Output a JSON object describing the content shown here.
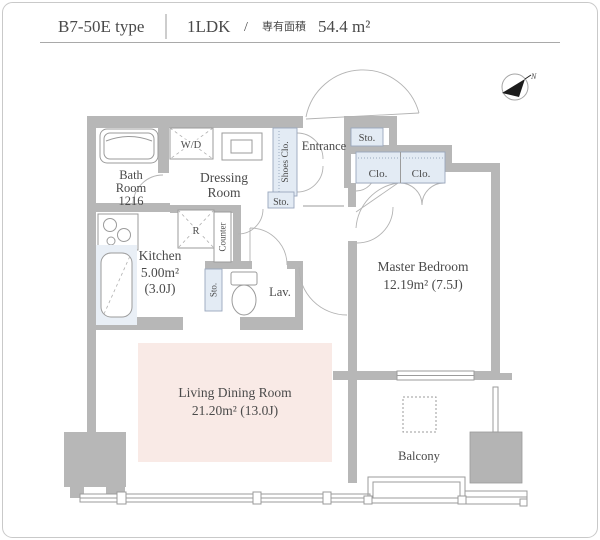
{
  "header": {
    "type_label": "B7-50E type",
    "layout_label": "1LDK",
    "separator": "/",
    "area_caption": "専有面積",
    "area_value": "54.4 m²"
  },
  "compass": {
    "label": "N"
  },
  "plan": {
    "bath": {
      "line1": "Bath",
      "line2": "Room",
      "line3": "1216"
    },
    "wd": {
      "label": "W/D"
    },
    "dressing": {
      "line1": "Dressing",
      "line2": "Room"
    },
    "shoes_closet": {
      "label": "Shoes Clo."
    },
    "hall_storage": {
      "label": "Sto."
    },
    "entrance": {
      "label": "Entrance"
    },
    "top_storage": {
      "label": "Sto."
    },
    "closets": {
      "left": "Clo.",
      "right": "Clo."
    },
    "kitchen": {
      "name": "Kitchen",
      "area": "5.00m²",
      "tatami": "(3.0J)"
    },
    "refrigerator": {
      "label": "R"
    },
    "counter": {
      "label": "Counter"
    },
    "lav_storage": {
      "label": "Sto."
    },
    "lavatory": {
      "label": "Lav."
    },
    "bedroom": {
      "name": "Master Bedroom",
      "area": "12.19m² (7.5J)"
    },
    "living": {
      "name": "Living Dining Room",
      "area": "21.20m² (13.0J)"
    },
    "balcony": {
      "name": "Balcony"
    }
  },
  "colors": {
    "wall": "#b7b7b7",
    "closet_fill": "#e3ebf4",
    "living_highlight": "#f9eae6",
    "line": "#9b9b9b",
    "text": "#4a4a4a"
  }
}
